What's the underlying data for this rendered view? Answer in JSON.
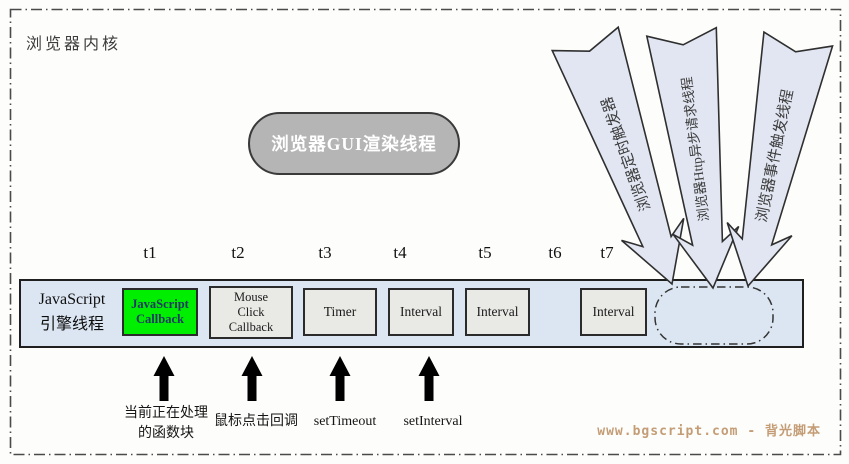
{
  "diagram": {
    "title": "浏览器内核",
    "gui_thread_label": "浏览器GUI渲染线程",
    "external_threads": [
      {
        "label": "浏览器定时触发器"
      },
      {
        "label": "浏览器Http异步请求线程"
      },
      {
        "label": "浏览器事件触发线程"
      }
    ],
    "engine_thread": {
      "label": "JavaScript\n引擎线程",
      "ticks": [
        "t1",
        "t2",
        "t3",
        "t4",
        "t5",
        "t6",
        "t7"
      ],
      "slots": [
        {
          "label": "JavaScript\nCallback",
          "state": "active"
        },
        {
          "label": "Mouse\nClick\nCallback",
          "state": "queued"
        },
        {
          "label": "Timer",
          "state": "queued"
        },
        {
          "label": "Interval",
          "state": "queued"
        },
        {
          "label": "Interval",
          "state": "queued"
        },
        {
          "label": "Interval",
          "state": "queued"
        }
      ]
    },
    "annotations": [
      {
        "label": "当前正在处理\n的函数块"
      },
      {
        "label": "鼠标点击回调"
      },
      {
        "label": "setTimeout"
      },
      {
        "label": "setInterval"
      }
    ],
    "watermark": "www.bgscript.com - 背光脚本",
    "colors": {
      "active_slot": "#00ee00",
      "queued_slot": "#e9e9e6",
      "thread_bar": "#dce6f2",
      "external_arrow": "#e1e6f2",
      "gui_oval": "#b5b5b5",
      "watermark_text": "#c49d76"
    }
  }
}
